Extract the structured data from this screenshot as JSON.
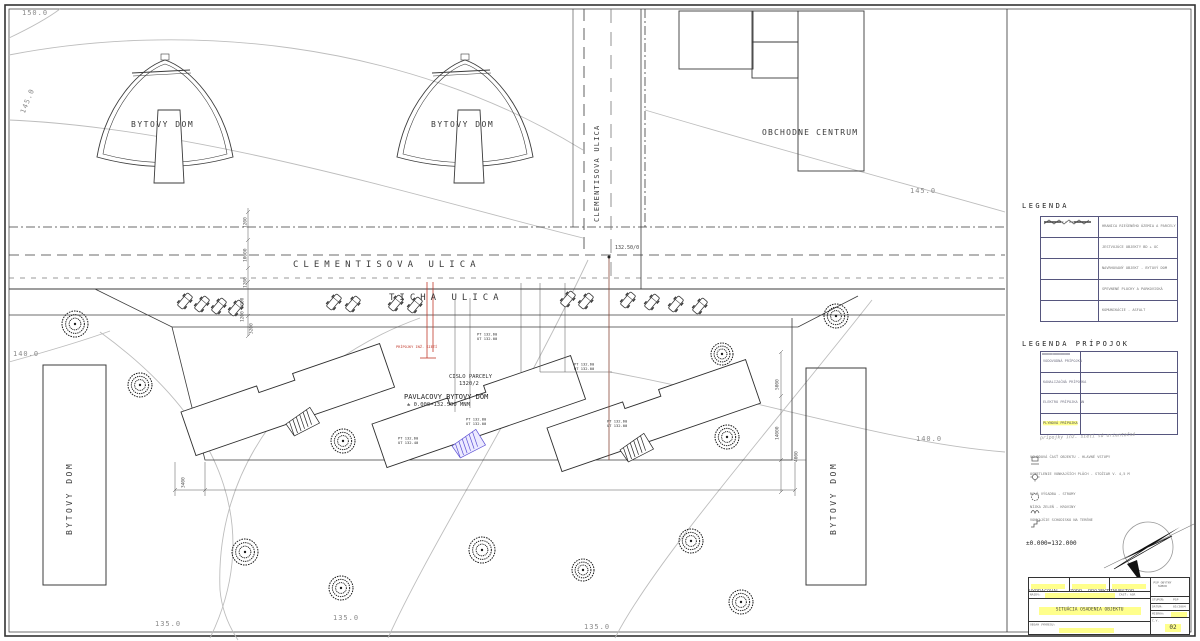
{
  "labels": {
    "contour_150": "150.0",
    "contour_145_left": "145.0",
    "contour_145_right": "145.0",
    "contour_140_left": "140.0",
    "contour_140_right": "140.0",
    "contour_135_a": "135.0",
    "contour_135_b": "135.0",
    "contour_135_c": "135.0",
    "dome_left": "BYTOVY DOM",
    "dome_right": "BYTOVY DOM",
    "shopping_center": "OBCHODNE CENTRUM",
    "street_vertical": "CLEMENTISOVA ULICA",
    "street_horizontal": "CLEMENTISOVA ULICA",
    "street_ticha": "TICHA ULICA",
    "block_left": "BYTOVY DOM",
    "block_right": "BYTOVY DOM",
    "main_building_1": "PAVLACOVY BYTOVY DOM",
    "main_building_2": "± 0.000=132.500 MNM",
    "parcel_1": "CISLO PARCELY",
    "parcel_2": "1320/2",
    "street_node": "132.50/0",
    "red_note": "PRÍPOJKY INŽ. SIETÍ"
  },
  "dims": {
    "v1": "1200",
    "v2": "10000",
    "v3": "1200",
    "v4": "1200 5000",
    "v5": "3200",
    "r1": "5000",
    "r2": "14000",
    "r3": "4000",
    "b1": "3400"
  },
  "spots": {
    "s1a": "PT 132.60",
    "s1b": "UT 132.00",
    "s2a": "PT 132.60",
    "s2b": "UT 132.00",
    "s3a": "PT 132.60",
    "s3b": "UT 132.00",
    "s4a": "PT 132.60",
    "s4b": "UT 132.40",
    "s5a": "PT 132.80",
    "s5b": "UT 132.00"
  },
  "legend": {
    "title": "LEGENDA",
    "rows": [
      "HRANICA RIEŠENÉHO ÚZEMIA A PARCELY",
      "JESTVUJÚCE OBJEKTY BD + OC",
      "NAVRHOVANÝ OBJEKT - BYTOVÝ DOM",
      "SPEVNENÉ PLOCHY A PARKOVISKÁ",
      "KOMUNIKÁCIE - ASFALT"
    ]
  },
  "legend2": {
    "title": "LEGENDA PRÍPOJOK",
    "rows": [
      "VODOVODNÁ PRÍPOJKA",
      "KANALIZAČNÁ PRÍPOJKA",
      "ELEKTRO PRÍPOJKA NN",
      "PLYNOVÁ PRÍPOJKA"
    ],
    "note": "prípojky inž. sietí sú orientačné"
  },
  "notes": [
    {
      "text": "VCHODOVÁ ČASŤ OBJEKTU - HLAVNÉ VSTUPY"
    },
    {
      "text": "OSVETLENIE VONKAJŠÍCH PLÔCH - STOŽIAR V. 4,5 M"
    },
    {
      "text": "NOVÁ VÝSADBA - STROMY"
    },
    {
      "text": "NÍZKA ZELEŇ - KROVINY"
    },
    {
      "text": "VONKAJŠIE SCHODISKO NA TERÉNE"
    }
  ],
  "datum": "±0.000=132.000",
  "titleblock": {
    "c1l": "VYPRACOVAL",
    "c1v": "ING. ARCH.",
    "c2l": "ZODP. PROJEKTANT",
    "c2v": "ING. ARCH.",
    "c3l": "INVESTOR",
    "c3v": "MESTO",
    "nazov_l": "NÁZOV:",
    "nazov_v": "OBYTNÝ SÚBOR - PAVLAČOVÝ BYTOVÝ DOM",
    "cast": "ČASŤ: ASR",
    "title": "SITUÁCIA OSADENIA OBJEKTU",
    "obsah_l": "OBSAH VÝKRESU:",
    "obsah_v": "SITUÁCIA",
    "org": "PSP OBYTNÝ SÚBOR",
    "r1l": "STUPEŇ:",
    "r1v": "PSP",
    "r2l": "DÁTUM:",
    "r2v": "05/2004",
    "r3l": "MIERKA:",
    "r3v": "1:250",
    "r4l": "Č.V.",
    "r4v": "02"
  }
}
